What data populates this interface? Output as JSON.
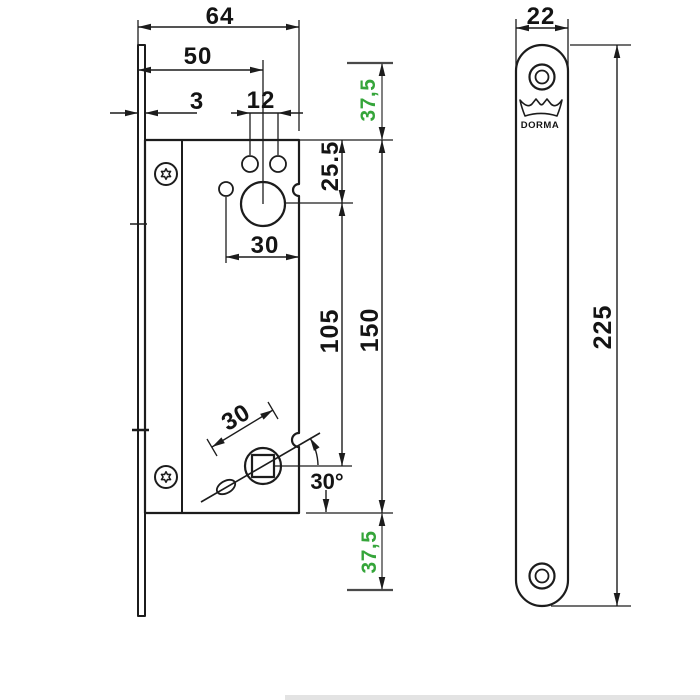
{
  "drawing": {
    "brand": "DORMA",
    "views": {
      "lock_case": {
        "dims": {
          "total_depth": "64",
          "backset": "50",
          "faceplate_thickness": "3",
          "cylinder_screw_spacing": "12",
          "cylinder_offset": "25.5",
          "cylinder_pocket_width": "30",
          "cylinder_to_follower": "105",
          "case_height": "150",
          "follower_lever_length": "30",
          "follower_angle": "30°",
          "top_margin": "37,5",
          "bottom_margin": "37,5"
        }
      },
      "faceplate": {
        "dims": {
          "width": "22",
          "length": "225"
        },
        "logo_text": "DORMA"
      }
    },
    "colors": {
      "line": "#1c1c1c",
      "accent_green": "#35a53a"
    }
  }
}
